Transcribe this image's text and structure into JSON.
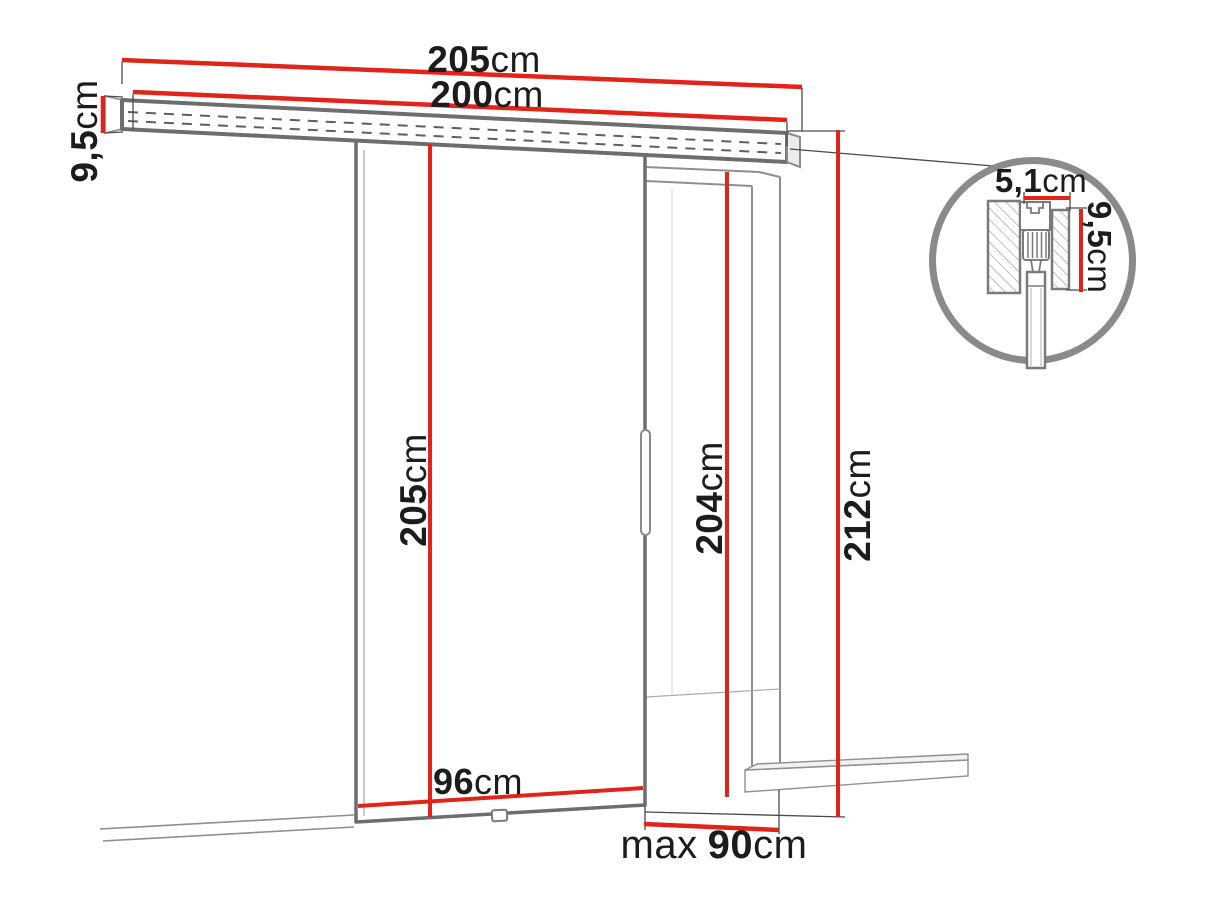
{
  "drawing": {
    "type": "sliding-door-dimension-diagram",
    "colors": {
      "dimension_red": "#e2231a",
      "outline_gray": "#6d6d6d",
      "label_black": "#1c1c1c"
    },
    "labels": {
      "track_total_width": {
        "value": "205",
        "unit": "cm"
      },
      "track_length": {
        "value": "200",
        "unit": "cm"
      },
      "track_height": {
        "value": "9,5",
        "unit": "cm"
      },
      "door_height": {
        "value": "205",
        "unit": "cm"
      },
      "door_width": {
        "value": "96",
        "unit": "cm"
      },
      "opening_height": {
        "value": "204",
        "unit": "cm"
      },
      "total_height": {
        "value": "212",
        "unit": "cm"
      },
      "max_clear_width": {
        "prefix": "max",
        "value": "90",
        "unit": "cm"
      },
      "detail_width": {
        "value": "5,1",
        "unit": "cm"
      },
      "detail_height": {
        "value": "9,5",
        "unit": "cm"
      }
    }
  }
}
